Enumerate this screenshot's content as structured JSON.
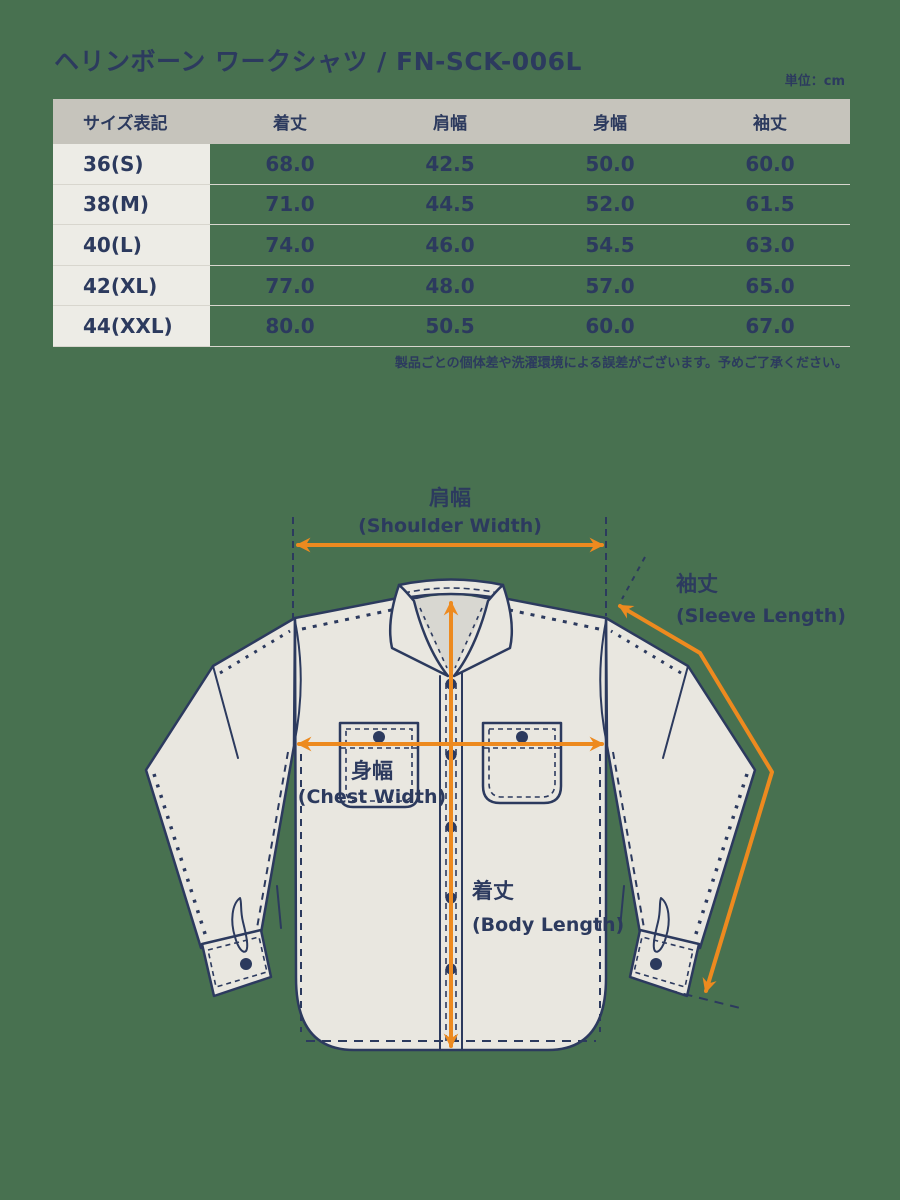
{
  "page": {
    "title": "ヘリンボーン ワークシャツ / FN-SCK-006L",
    "unit_label": "単位：cm",
    "background_green": "#487150",
    "text_navy": "#2c3a5e",
    "accent_orange": "#ed8a1f"
  },
  "size_table": {
    "columns": [
      "サイズ表記",
      "着丈",
      "肩幅",
      "身幅",
      "袖丈"
    ],
    "rows": [
      {
        "size": "36(S)",
        "values": [
          "68.0",
          "42.5",
          "50.0",
          "60.0"
        ]
      },
      {
        "size": "38(M)",
        "values": [
          "71.0",
          "44.5",
          "52.0",
          "61.5"
        ]
      },
      {
        "size": "40(L)",
        "values": [
          "74.0",
          "46.0",
          "54.5",
          "63.0"
        ]
      },
      {
        "size": "42(XL)",
        "values": [
          "77.0",
          "48.0",
          "57.0",
          "65.0"
        ]
      },
      {
        "size": "44(XXL)",
        "values": [
          "80.0",
          "50.5",
          "60.0",
          "67.0"
        ]
      }
    ],
    "header_bg": "#c6c4bc",
    "label_col_bg": "#edece6",
    "note": "製品ごとの個体差や洗濯環境による誤差がございます。予めご了承ください。"
  },
  "diagram": {
    "shirt_fill": "#e9e7e0",
    "collar_inner_fill": "#d8d7d1",
    "labels": {
      "shoulder_jp": "肩幅",
      "shoulder_en": "(Shoulder Width)",
      "sleeve_jp": "袖丈",
      "sleeve_en": "(Sleeve Length)",
      "chest_jp": "身幅",
      "chest_en": "(Chest Width)",
      "body_jp": "着丈",
      "body_en": "(Body Length)"
    }
  }
}
